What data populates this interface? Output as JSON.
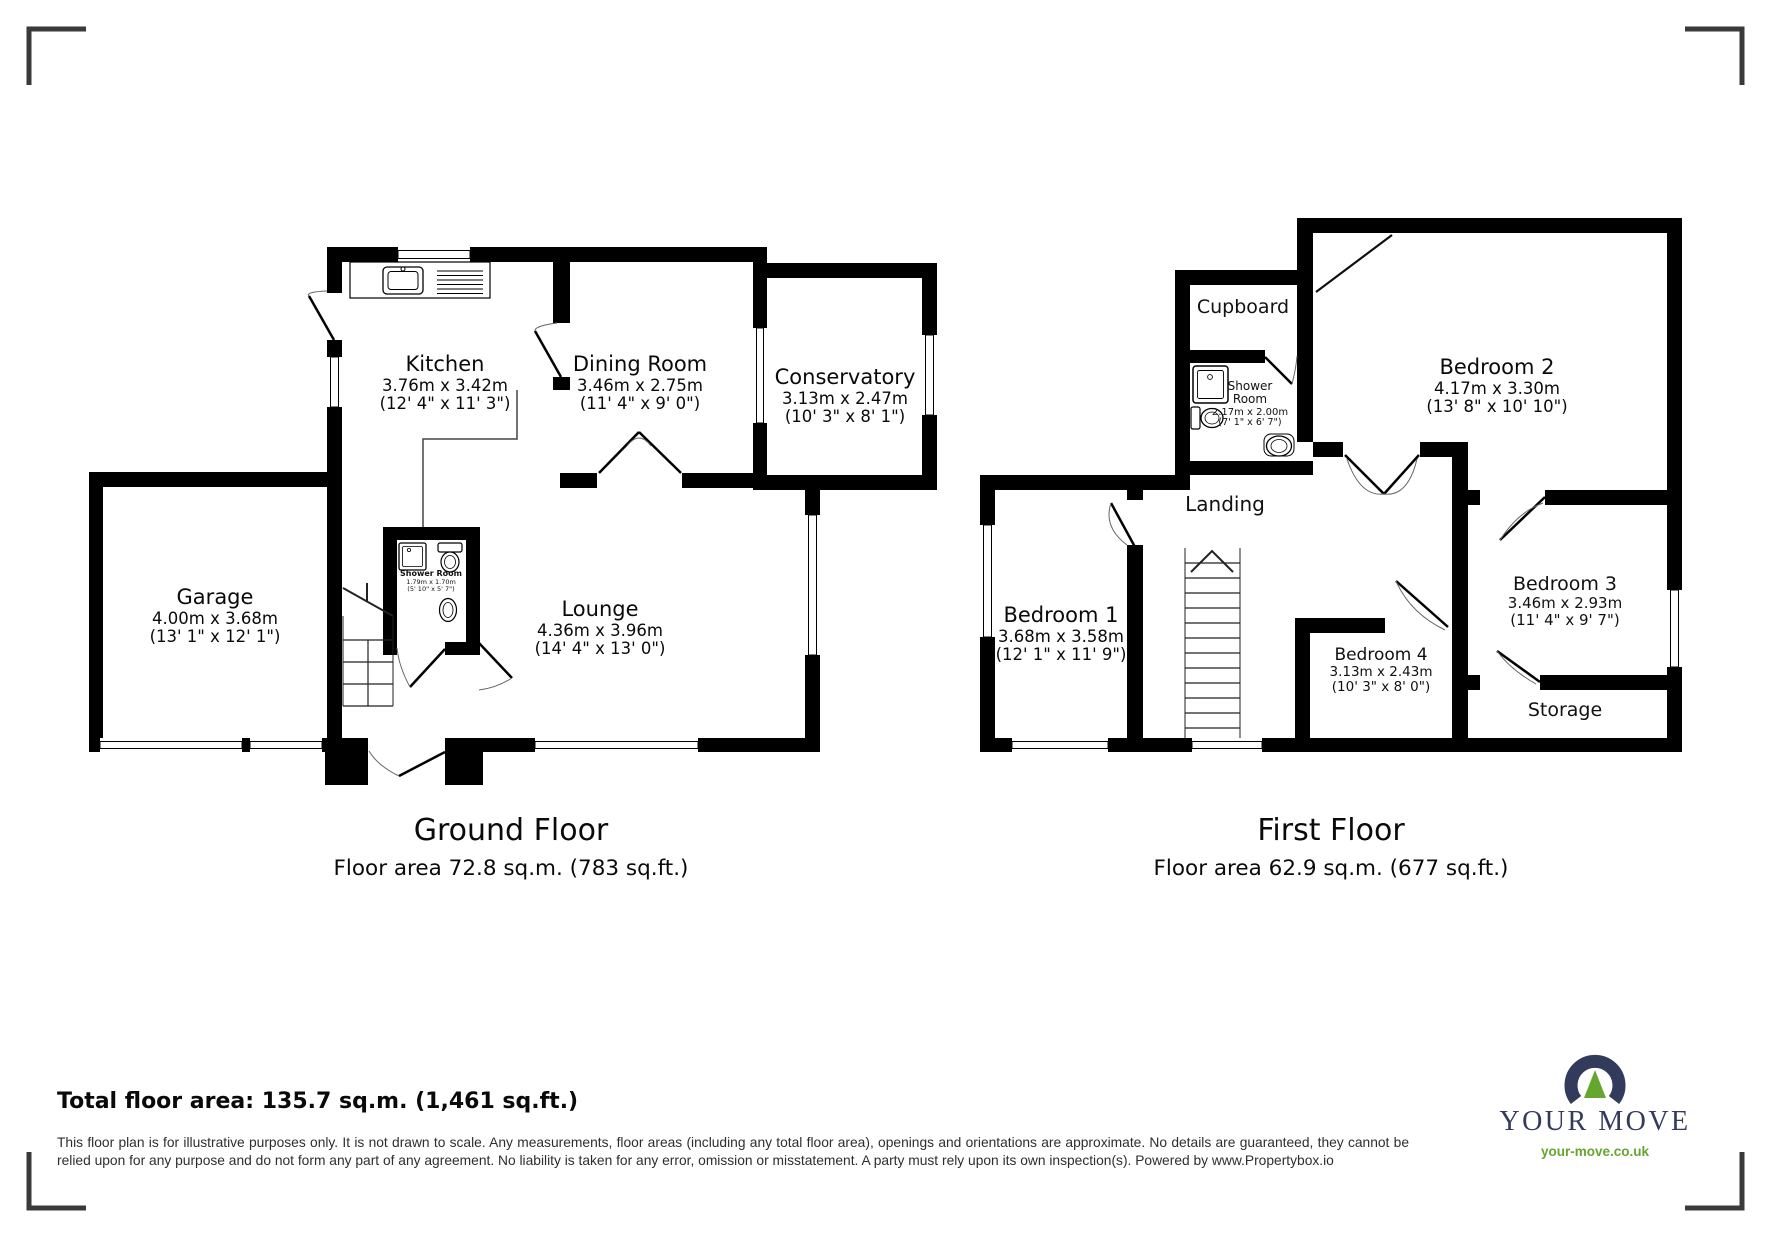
{
  "ground": {
    "title": "Ground Floor",
    "area_line": "Floor area 72.8 sq.m. (783 sq.ft.)",
    "rooms": {
      "kitchen": {
        "name": "Kitchen",
        "metric": "3.76m x 3.42m",
        "imperial": "(12' 4\" x 11' 3\")"
      },
      "dining": {
        "name": "Dining Room",
        "metric": "3.46m x 2.75m",
        "imperial": "(11' 4\" x 9' 0\")"
      },
      "conservatory": {
        "name": "Conservatory",
        "metric": "3.13m x 2.47m",
        "imperial": "(10' 3\" x 8' 1\")"
      },
      "garage": {
        "name": "Garage",
        "metric": "4.00m x 3.68m",
        "imperial": "(13' 1\" x 12' 1\")"
      },
      "lounge": {
        "name": "Lounge",
        "metric": "4.36m x 3.96m",
        "imperial": "(14' 4\" x 13' 0\")"
      },
      "shower": {
        "name": "Shower Room",
        "metric": "1.79m x 1.70m",
        "imperial": "(5' 10\" x 5' 7\")"
      }
    }
  },
  "first": {
    "title": "First Floor",
    "area_line": "Floor area 62.9 sq.m. (677 sq.ft.)",
    "rooms": {
      "cupboard": {
        "name": "Cupboard"
      },
      "shower": {
        "name_l1": "Shower",
        "name_l2": "Room",
        "metric": "2.17m x 2.00m",
        "imperial": "(7' 1\" x 6' 7\")"
      },
      "bedroom2": {
        "name": "Bedroom 2",
        "metric": "4.17m x 3.30m",
        "imperial": "(13' 8\" x 10' 10\")"
      },
      "landing": {
        "name": "Landing"
      },
      "bedroom1": {
        "name": "Bedroom 1",
        "metric": "3.68m x 3.58m",
        "imperial": "(12' 1\" x 11' 9\")"
      },
      "bedroom4": {
        "name": "Bedroom 4",
        "metric": "3.13m x 2.43m",
        "imperial": "(10' 3\" x 8' 0\")"
      },
      "bedroom3": {
        "name": "Bedroom 3",
        "metric": "3.46m x 2.93m",
        "imperial": "(11' 4\" x 9' 7\")"
      },
      "storage": {
        "name": "Storage"
      }
    }
  },
  "footer": {
    "total": "Total floor area: 135.7 sq.m. (1,461 sq.ft.)",
    "disclaimer": "This floor plan is for illustrative purposes only. It is not drawn to scale. Any measurements, floor areas (including any total floor area), openings and orientations are approximate. No details are guaranteed, they cannot be relied upon for any purpose and do not form any part of any agreement. No liability is taken for any error, omission or misstatement. A party must rely upon its own inspection(s). Powered by www.Propertybox.io"
  },
  "logo": {
    "brand": "YOUR MOVE",
    "url": "your-move.co.uk",
    "navy": "#333b5c",
    "green": "#64a62e"
  }
}
